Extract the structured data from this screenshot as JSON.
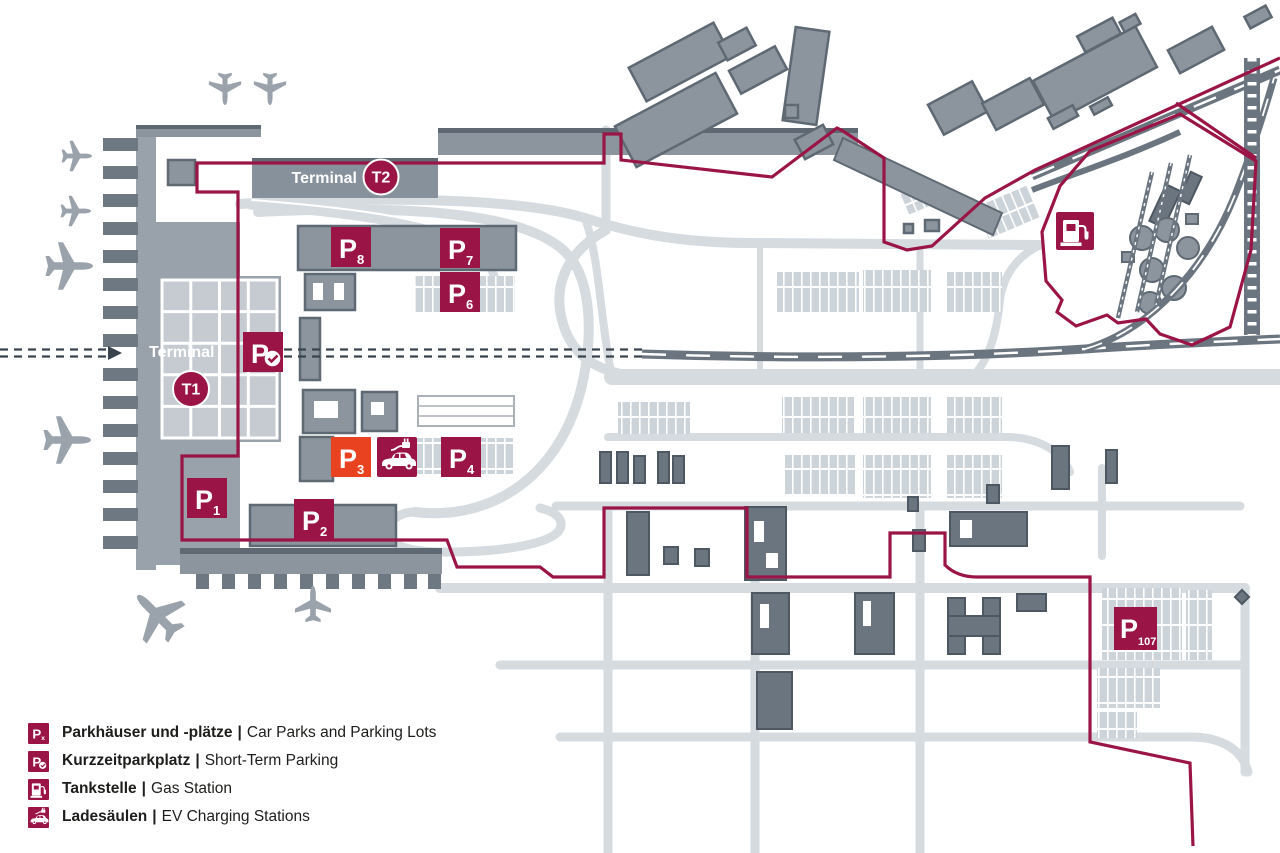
{
  "map": {
    "terminal_t2": {
      "label": "Terminal",
      "code": "T2"
    },
    "terminal_t1": {
      "label": "Terminal",
      "code": "T1"
    },
    "short_term_badge": {
      "p": "P"
    },
    "parking_badges": [
      {
        "id": "P8",
        "p": "P",
        "sub": "8"
      },
      {
        "id": "P7",
        "p": "P",
        "sub": "7"
      },
      {
        "id": "P6",
        "p": "P",
        "sub": "6"
      },
      {
        "id": "P3",
        "p": "P",
        "sub": "3"
      },
      {
        "id": "P4",
        "p": "P",
        "sub": "4"
      },
      {
        "id": "P1",
        "p": "P",
        "sub": "1"
      },
      {
        "id": "P2",
        "p": "P",
        "sub": "2"
      },
      {
        "id": "P107",
        "p": "P",
        "sub": "107"
      }
    ]
  },
  "legend": {
    "items": [
      {
        "icon": "car-parks-icon",
        "badge": "P",
        "badge_sub": "x",
        "de": "Parkhäuser und -plätze",
        "sep": "|",
        "en": "Car Parks and Parking Lots"
      },
      {
        "icon": "short-term-parking-icon",
        "badge": "P",
        "de": "Kurzzeitparkplatz",
        "sep": "|",
        "en": "Short-Term Parking"
      },
      {
        "icon": "gas-station-icon",
        "de": "Tankstelle",
        "sep": "|",
        "en": "Gas Station"
      },
      {
        "icon": "ev-charging-icon",
        "de": "Ladesäulen",
        "sep": "|",
        "en": "EV Charging Stations"
      }
    ]
  },
  "colors": {
    "brand_maroon": "#9a1546",
    "p3_orange": "#e84220",
    "building_gray": "#8c959d",
    "building_dark": "#5f6973",
    "road_gray": "#d6dbe0",
    "terminal_gray": "#99a1aa"
  }
}
